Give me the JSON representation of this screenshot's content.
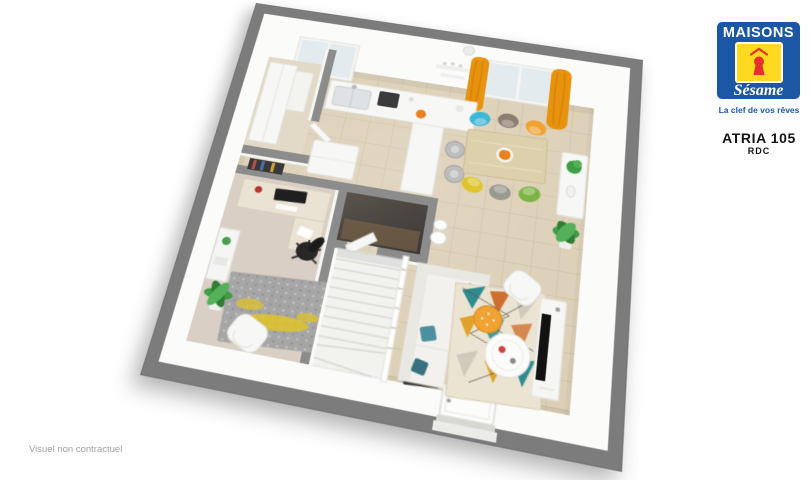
{
  "brand": {
    "wordmark_top": "MAISONS",
    "wordmark_script": "Sésame",
    "tagline": "La clef de vos rêves",
    "colors": {
      "blue": "#1c57a6",
      "yellow": "#ffd91f",
      "red": "#e5312a",
      "white": "#ffffff"
    }
  },
  "model": {
    "title": "ATRIA 105",
    "level": "RDC"
  },
  "footer": {
    "disclaimer": "Visuel non contractuel"
  },
  "floorplan": {
    "type": "3d-floor-plan-render",
    "rooms": [
      "kitchen",
      "dining-area",
      "living-room",
      "office",
      "wc",
      "storage",
      "hallway",
      "staircase",
      "entrance"
    ],
    "palette": {
      "wall_top_gray": "#7c7c7c",
      "wall_face_white": "#fbfbf9",
      "floor_tile": "#dccfb6",
      "floor_office": "#d9cfc4",
      "curtain_orange": "#e8930e",
      "pouf_orange": "#f0a232",
      "pillow_teal": "#3e7f90",
      "plant_green": "#3f9d44",
      "table_wood": "#ddd0ac",
      "tv_black": "#121212",
      "dining_chairs": [
        "#3fb8d6",
        "#8b7d70",
        "#f2a233",
        "#dfc52c",
        "#999990",
        "#7cb342"
      ],
      "rug_triangles": [
        "#2f8b8e",
        "#d07030",
        "#dfa32b",
        "#cfcabc"
      ],
      "office_rug_yellow": "#e2c520"
    }
  }
}
